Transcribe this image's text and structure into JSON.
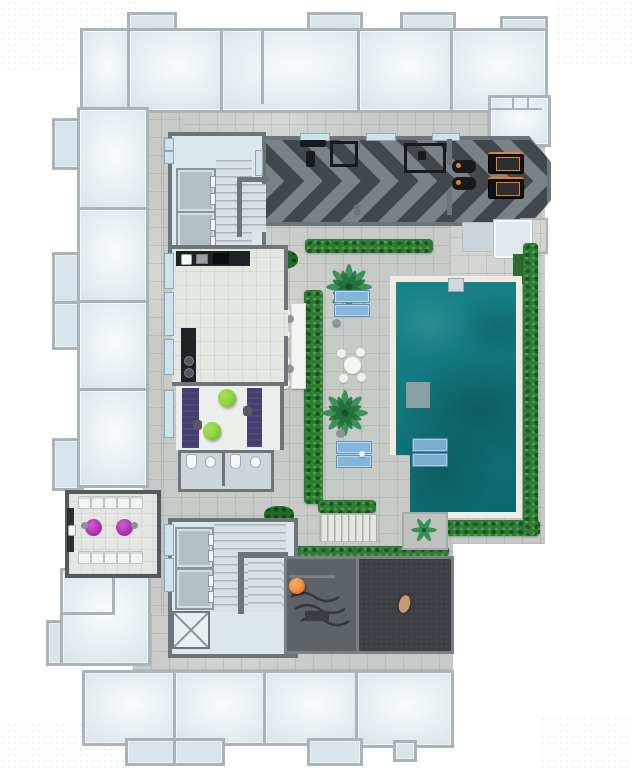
{
  "image_type": "architectural floor plan rendering, top-down amenity level of a residential tower, no visible text",
  "palette": {
    "wall": "#a9b3b8",
    "coreWall": "#6d747a",
    "paver": "#c8cac7",
    "floorCool": "#dde6ea",
    "floorWarm": "#e4e6e2",
    "water": "#17848a",
    "waterDeep": "#0c686d",
    "coping": "#eeece3",
    "hedge": "#2e7c33",
    "lounger": "#85b5da",
    "gymDark": "#42474c",
    "gymLight": "#7a8187",
    "equip": "#17191b",
    "equipOrange": "#e0851f",
    "magenta": "#ab31ae",
    "purple": "#463d70",
    "lime": "#8ed23e",
    "orange": "#f08a3c",
    "darkA": "#5d6266",
    "darkB": "#3c0404aNOTUSED"
  },
  "inventory": {
    "ghost_units_top_row": 5,
    "ghost_units_left_column": 5,
    "ghost_units_bottom_row": 4,
    "elevators": 4,
    "stairwells": 2,
    "service_shaft_x_marked": 1,
    "treadmills": 2,
    "spin_bikes": 2,
    "deck_sun_loungers": 4,
    "in_pool_loungers": 2,
    "palm_trees": 3,
    "bar_stools": 6,
    "party_room_chairs": 10,
    "magenta_tables": 2,
    "green_bean_bags": 2,
    "orange_bean_bag": 1,
    "restrooms": 2,
    "round_table_sets": 1,
    "pools": 1
  }
}
